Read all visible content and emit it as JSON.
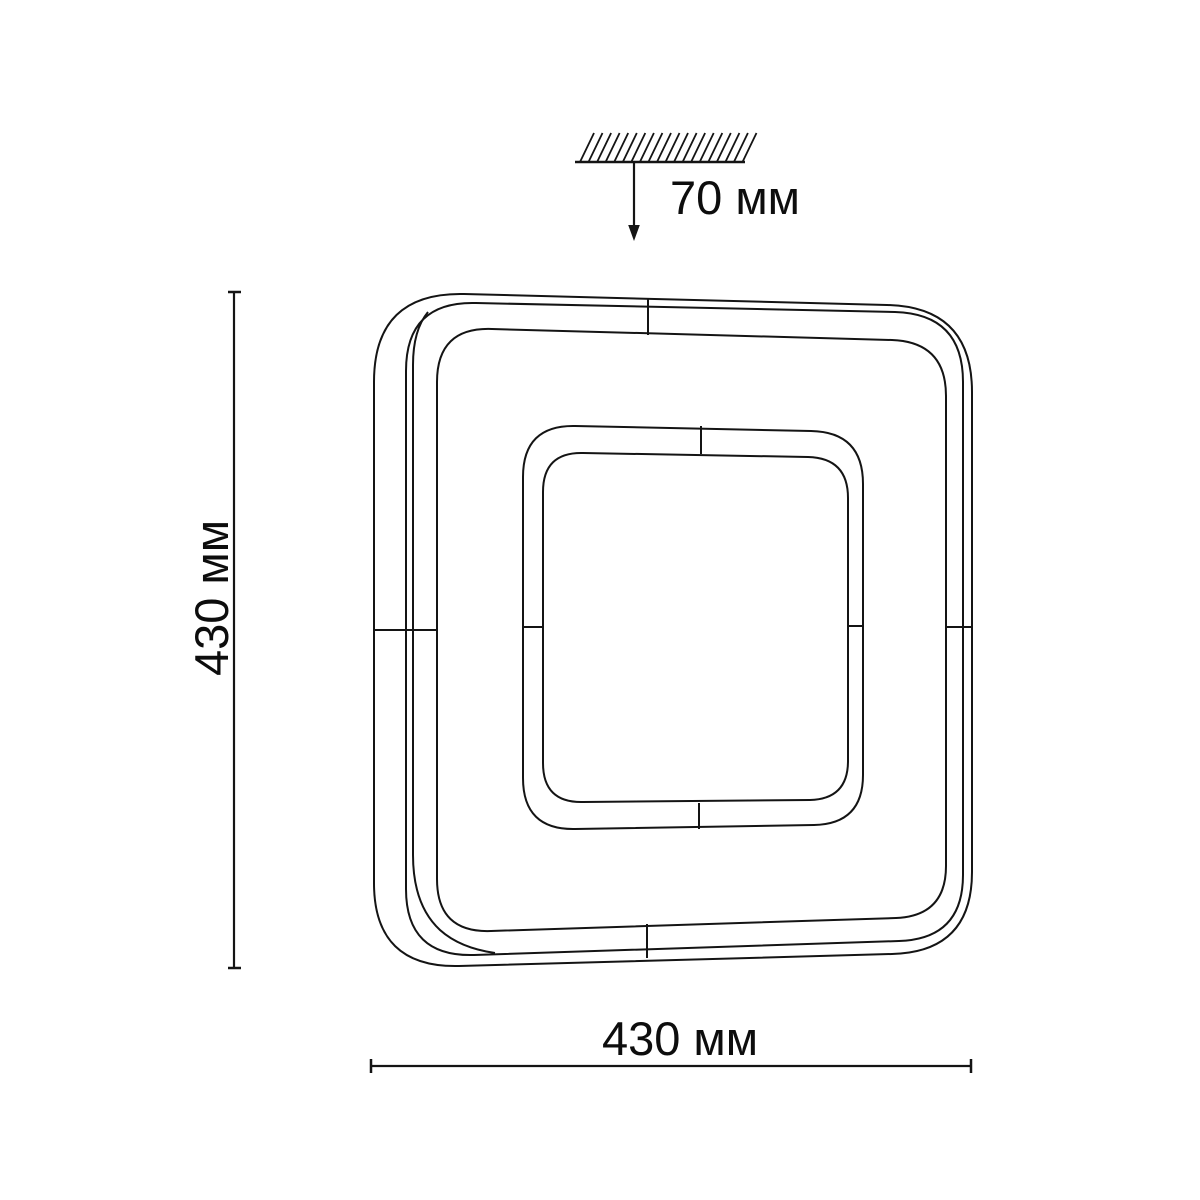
{
  "drawing": {
    "title": "ceiling light fixture dimension drawing",
    "labels": {
      "ceiling_offset": "70 мм",
      "fixture_height": "430 мм",
      "fixture_width": "430 мм"
    },
    "dimensions": {
      "ceiling_offset_mm": 70,
      "width_mm": 430,
      "height_mm": 430,
      "unit": "мм"
    },
    "colors": {
      "line": "#141414",
      "text": "#0d0d0d",
      "background": "#ffffff"
    }
  }
}
